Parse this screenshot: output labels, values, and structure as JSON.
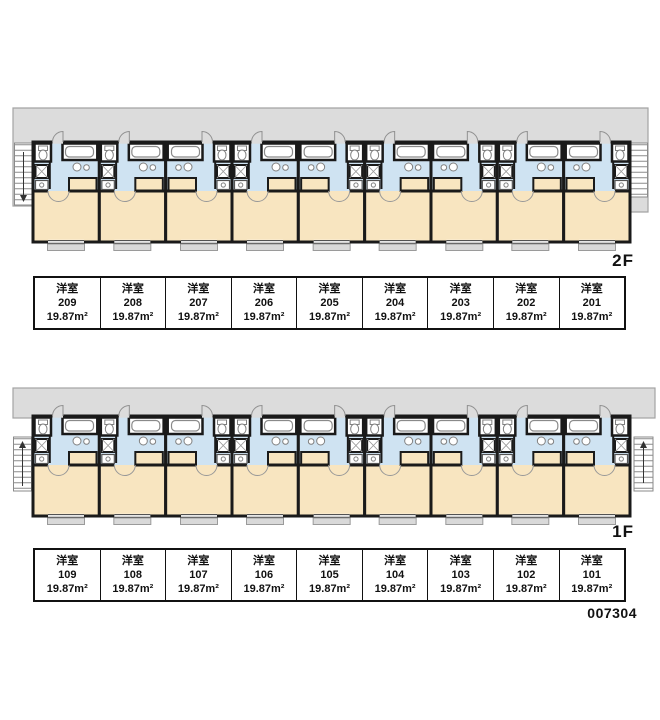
{
  "document": {
    "plan_id": "007304"
  },
  "colors": {
    "wet_zone": "#cfe3f2",
    "living_zone": "#f8e5c0",
    "walkway": "#dcdcdc",
    "wall": "#1a1a1a",
    "window_tab": "#d9d9d9"
  },
  "floors": [
    {
      "label": "2F",
      "units": [
        {
          "type": "洋室",
          "number": "209",
          "area": "19.87m²"
        },
        {
          "type": "洋室",
          "number": "208",
          "area": "19.87m²"
        },
        {
          "type": "洋室",
          "number": "207",
          "area": "19.87m²"
        },
        {
          "type": "洋室",
          "number": "206",
          "area": "19.87m²"
        },
        {
          "type": "洋室",
          "number": "205",
          "area": "19.87m²"
        },
        {
          "type": "洋室",
          "number": "204",
          "area": "19.87m²"
        },
        {
          "type": "洋室",
          "number": "203",
          "area": "19.87m²"
        },
        {
          "type": "洋室",
          "number": "202",
          "area": "19.87m²"
        },
        {
          "type": "洋室",
          "number": "201",
          "area": "19.87m²"
        }
      ]
    },
    {
      "label": "1F",
      "units": [
        {
          "type": "洋室",
          "number": "109",
          "area": "19.87m²"
        },
        {
          "type": "洋室",
          "number": "108",
          "area": "19.87m²"
        },
        {
          "type": "洋室",
          "number": "107",
          "area": "19.87m²"
        },
        {
          "type": "洋室",
          "number": "106",
          "area": "19.87m²"
        },
        {
          "type": "洋室",
          "number": "105",
          "area": "19.87m²"
        },
        {
          "type": "洋室",
          "number": "104",
          "area": "19.87m²"
        },
        {
          "type": "洋室",
          "number": "103",
          "area": "19.87m²"
        },
        {
          "type": "洋室",
          "number": "102",
          "area": "19.87m²"
        },
        {
          "type": "洋室",
          "number": "101",
          "area": "19.87m²"
        }
      ]
    }
  ]
}
